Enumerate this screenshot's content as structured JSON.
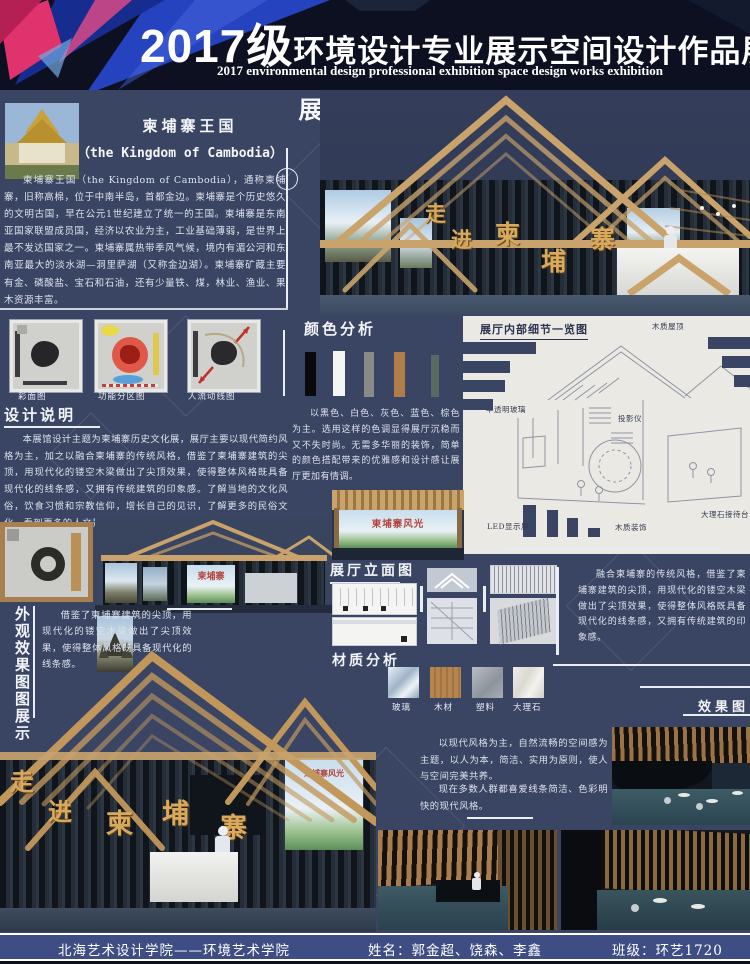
{
  "colors": {
    "background": "#3a4564",
    "header_bg": "#0d1020",
    "accent_blue": "#2746c8",
    "accent_pink": "#e0336e",
    "wood": "#c9a36b",
    "gold_text": "#d9a95e",
    "dark_wall": "#1b222b",
    "panel_light": "#ebe9e3",
    "footer_bar": "#3e4e85"
  },
  "header": {
    "title_year": "2017级",
    "title_main": "环境设计专业展示空间设计作品展",
    "subtitle": "2017 environmental design professional exhibition space design works exhibition"
  },
  "intro": {
    "title": "柬埔寨王国",
    "subtitle": "（the Kingdom of Cambodia）",
    "body": "柬埔寨王国（the Kingdom of Cambodia），通称柬埔寨，旧称高棉，位于中南半岛，首都金边。柬埔寨是个历史悠久的文明古国，早在公元1世纪建立了统一的王国。柬埔寨是东南亚国家联盟成员国，经济以农业为主，工业基础薄弱，是世界上最不发达国家之一。柬埔寨属热带季风气候，境内有湄公河和东南亚最大的淡水湖—洞里萨湖（又称金边湖）。柬埔寨矿藏主要有金、磷酸盐、宝石和石油，还有少量铁、煤，林业、渔业、果木资源丰富。"
  },
  "vertical_title": "柬埔寨遗迹文化展",
  "entrance": {
    "chars": [
      "走",
      "进",
      "柬",
      "埔",
      "寨"
    ]
  },
  "plans": {
    "items": [
      {
        "label": "彩面图"
      },
      {
        "label": "功能分区图"
      },
      {
        "label": "人流动线图"
      }
    ]
  },
  "design_notes": {
    "heading": "设计说明",
    "body": "本展馆设计主题为柬埔寨历史文化展，展厅主要以现代简约风格为主，加之以融合柬埔寨的传统风格，借鉴了柬埔寨建筑的尖顶，用现代化的镂空木梁做出了尖顶效果，使得整体风格既具备现代化的线条感，又拥有传统建筑的印象感。了解当地的文化风俗，饮食习惯和宗教信仰，增长自己的见识，了解更多的民俗文化，看到更多的人文景色使自己的内心感到充实。"
  },
  "color_analysis": {
    "heading": "颜色分析",
    "palette": [
      {
        "name": "黑色",
        "hex": "#0a0a0c"
      },
      {
        "name": "白色",
        "hex": "#f5f5f5"
      },
      {
        "name": "灰色",
        "hex": "#8a8a88"
      },
      {
        "name": "棕色",
        "hex": "#b07c4a"
      },
      {
        "name": "灰绿色",
        "hex": "#5a6a62"
      }
    ],
    "body": "以黑色、白色、灰色、蓝色、棕色为主。选用这样的色调显得展厅沉稳而又不失时尚。无需多华丽的装饰，简单的颜色搭配带来的优雅感和设计感让展厅更加有情调。"
  },
  "interior_detail": {
    "heading": "展厅内部细节一览图",
    "labels": {
      "roof": "木质屋顶",
      "glass": "半透明玻璃",
      "projector": "投影仪",
      "led": "LED显示屏",
      "wood_decor": "木质装饰",
      "marble_desk": "大理石接待台"
    }
  },
  "elevation": {
    "heading": "展厅立面图"
  },
  "materials": {
    "heading": "材质分析",
    "items": [
      {
        "label": "玻璃"
      },
      {
        "label": "木材"
      },
      {
        "label": "塑料"
      },
      {
        "label": "大理石"
      }
    ]
  },
  "fusion": {
    "body": "融合柬埔寨的传统风格，借鉴了柬埔寨建筑的尖顶，用现代化的镂空木梁做出了尖顶效果，使得整体风格既具备现代化的线条感，又拥有传统建筑的印象感。"
  },
  "exterior": {
    "vertical_label": "外观效果图图展示",
    "body": "借鉴了柬埔寨建筑的尖顶，用现代化的镂空木梁做出了尖顶效果，使得整体风格既具备现代化的线条感。"
  },
  "mural": {
    "title": "柬埔寨风光"
  },
  "facade": {
    "poster_title": "柬埔寨"
  },
  "result": {
    "label": "效果图"
  },
  "modern": {
    "p1": "以现代风格为主，自然流畅的空间感为主题，以人为本，简洁、实用为原则，使人与空间完美共养。",
    "p2": "现在多数人群都喜爱线条简洁、色彩明快的现代风格。"
  },
  "footer": {
    "school": "北海艺术设计学院——环境艺术学院",
    "names": "姓名：郭金超、饶森、李鑫",
    "class_name": "班级：环艺1720"
  }
}
